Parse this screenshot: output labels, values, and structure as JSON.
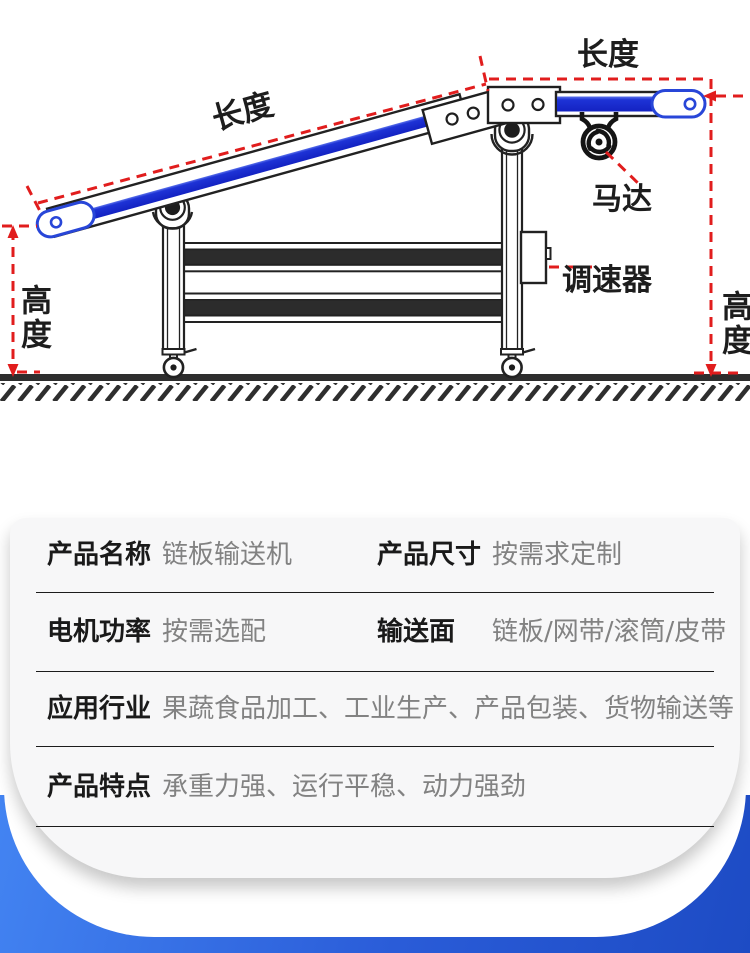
{
  "diagram": {
    "dimension_labels": {
      "length_top": "长度",
      "length_incline": "长度",
      "height_left": "高度",
      "height_right": "高度"
    },
    "part_labels": {
      "motor": "马达",
      "speed_controller": "调速器"
    },
    "colors": {
      "belt_blue": "#1b2ed0",
      "roller_blue": "#2846d8",
      "dimension_red": "#e11d1d",
      "outline_black": "#222222",
      "ground_gray": "#2e2e2e"
    }
  },
  "spec_card": {
    "rows": [
      {
        "cells": [
          {
            "label": "产品名称",
            "value": "链板输送机"
          },
          {
            "label": "产品尺寸",
            "value": "按需求定制"
          }
        ]
      },
      {
        "cells": [
          {
            "label": "电机功率",
            "value": "按需选配"
          },
          {
            "label": "输送面",
            "value": "链板/网带/滚筒/皮带"
          }
        ]
      },
      {
        "cells": [
          {
            "label": "应用行业",
            "value": "果蔬食品加工、工业生产、产品包装、货物输送等"
          }
        ]
      },
      {
        "cells": [
          {
            "label": "产品特点",
            "value": "承重力强、运行平稳、动力强劲"
          }
        ]
      }
    ]
  },
  "background": {
    "accent_gradient_start": "#4384f2",
    "accent_gradient_end": "#1d4bc4"
  }
}
